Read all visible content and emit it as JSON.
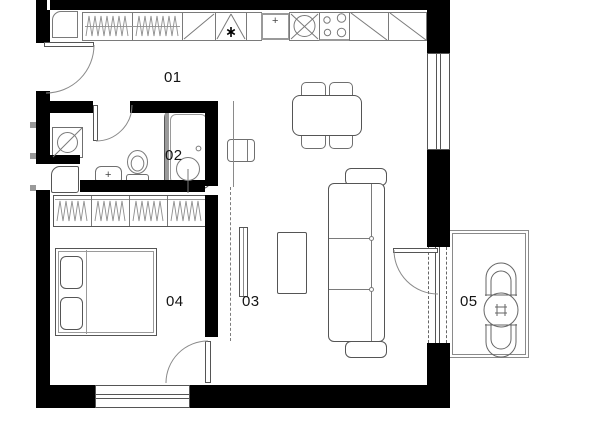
{
  "plan": {
    "type": "apartment-floor-plan",
    "room_labels": [
      {
        "label": "01"
      },
      {
        "label": "02"
      },
      {
        "label": "03"
      },
      {
        "label": "04"
      },
      {
        "label": "05"
      }
    ],
    "symbols": {
      "star_icon": "✱",
      "sink_cross": "+"
    },
    "colors": {
      "wall": "#000000",
      "outline": "#6f6f6f",
      "fixture_accent": "#9a9a9a",
      "label_text": "#141414",
      "background": "#ffffff"
    }
  }
}
